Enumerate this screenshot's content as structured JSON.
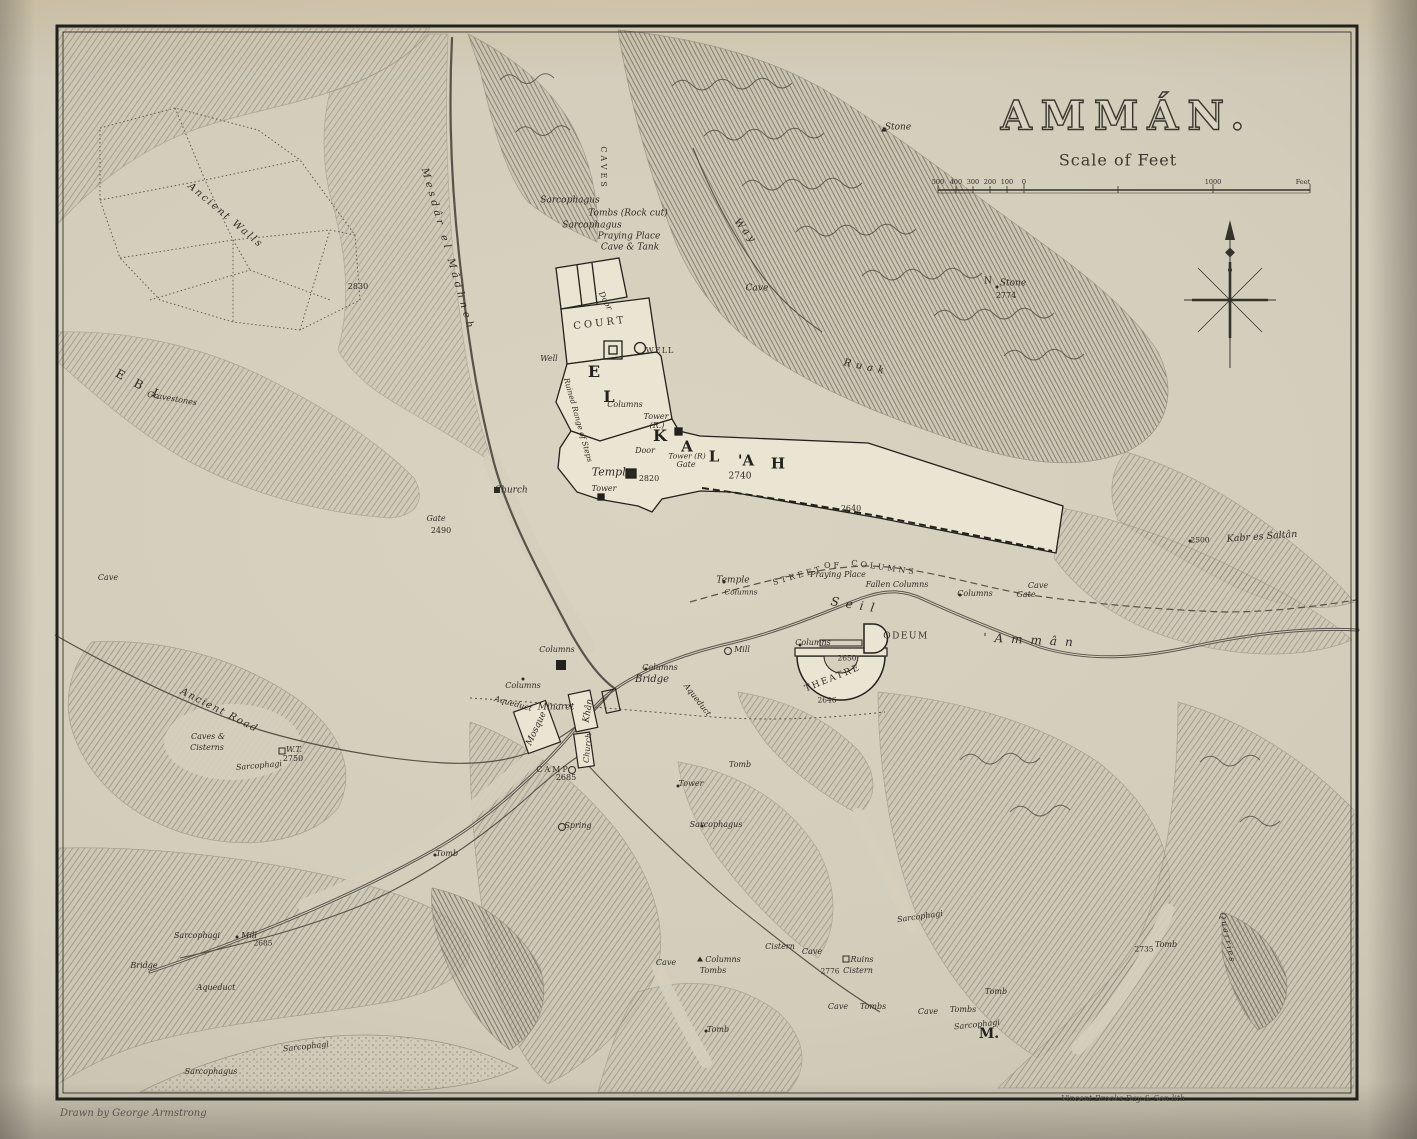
{
  "title": "AMMÁN.",
  "scale": {
    "caption": "Scale of Feet"
  },
  "credits": {
    "left": "Drawn by George Armstrong",
    "right": "Vincent Brooks Day & Son lith"
  },
  "colors": {
    "paper": "#d6d0bd",
    "ink": "#2e2b24",
    "terrain": "#7d786a"
  },
  "compass": {
    "icon": "compass-rose-north-arrow"
  },
  "labels": [
    {
      "t": "500",
      "x": 938,
      "y": 182,
      "s": 6.5,
      "c": "rom"
    },
    {
      "t": "400",
      "x": 956,
      "y": 182,
      "s": 6.5,
      "c": "rom"
    },
    {
      "t": "300",
      "x": 973,
      "y": 182,
      "s": 6.5,
      "c": "rom"
    },
    {
      "t": "200",
      "x": 990,
      "y": 182,
      "s": 6.5,
      "c": "rom"
    },
    {
      "t": "100",
      "x": 1007,
      "y": 182,
      "s": 6.5,
      "c": "rom"
    },
    {
      "t": "0",
      "x": 1024,
      "y": 182,
      "s": 6.5,
      "c": "rom"
    },
    {
      "t": "1000",
      "x": 1213,
      "y": 182,
      "s": 6.5,
      "c": "rom"
    },
    {
      "t": "Feet",
      "x": 1303,
      "y": 182,
      "s": 6.5,
      "c": "rom"
    },
    {
      "t": "Stone",
      "x": 898,
      "y": 128,
      "s": 9
    },
    {
      "t": "Stone",
      "x": 1013,
      "y": 284,
      "s": 9
    },
    {
      "t": "2774",
      "x": 1006,
      "y": 296,
      "s": 8,
      "c": "rom"
    },
    {
      "t": "N",
      "x": 988,
      "y": 282,
      "s": 9,
      "c": "rom"
    },
    {
      "t": "Way",
      "x": 745,
      "y": 232,
      "r": 50,
      "s": 10,
      "ls": 3
    },
    {
      "t": "CAVES",
      "x": 603,
      "y": 168,
      "r": 90,
      "s": 8,
      "ls": 3,
      "c": "caps"
    },
    {
      "t": "Sarcophagus",
      "x": 570,
      "y": 201,
      "s": 9
    },
    {
      "t": "Tombs (Rock cut)",
      "x": 628,
      "y": 214,
      "s": 9
    },
    {
      "t": "Sarcophagus",
      "x": 592,
      "y": 226,
      "s": 9
    },
    {
      "t": "Praying Place",
      "x": 629,
      "y": 237,
      "s": 9
    },
    {
      "t": "Cave & Tank",
      "x": 630,
      "y": 248,
      "s": 9
    },
    {
      "t": "Cave",
      "x": 757,
      "y": 289,
      "s": 9
    },
    {
      "t": "Ancient Walls",
      "x": 225,
      "y": 216,
      "r": 40,
      "s": 10,
      "ls": 2
    },
    {
      "t": "2830",
      "x": 358,
      "y": 287,
      "s": 8,
      "c": "rom"
    },
    {
      "t": "Mesdâr el Mâdhneh",
      "x": 447,
      "y": 250,
      "r": 74,
      "s": 10,
      "ls": 4
    },
    {
      "t": "Ruak",
      "x": 866,
      "y": 368,
      "r": 12,
      "s": 10,
      "ls": 5
    },
    {
      "t": "E B L",
      "x": 140,
      "y": 385,
      "r": 28,
      "s": 12,
      "ls": 4,
      "c": "rom"
    },
    {
      "t": "Gravestones",
      "x": 172,
      "y": 399,
      "r": 10,
      "s": 8
    },
    {
      "t": "COURT",
      "x": 600,
      "y": 324,
      "r": -7,
      "s": 10,
      "ls": 3,
      "c": "caps"
    },
    {
      "t": "Door",
      "x": 605,
      "y": 301,
      "r": 62,
      "s": 8
    },
    {
      "t": "WELL",
      "x": 660,
      "y": 351,
      "s": 8,
      "ls": 1,
      "c": "caps"
    },
    {
      "t": "Well",
      "x": 549,
      "y": 359,
      "s": 8
    },
    {
      "t": "E",
      "x": 594,
      "y": 372,
      "s": 16,
      "c": "big"
    },
    {
      "t": "L",
      "x": 609,
      "y": 397,
      "s": 16,
      "c": "big"
    },
    {
      "t": "K",
      "x": 660,
      "y": 436,
      "s": 16,
      "c": "big"
    },
    {
      "t": "A",
      "x": 687,
      "y": 447,
      "s": 15,
      "c": "big"
    },
    {
      "t": "L",
      "x": 714,
      "y": 457,
      "s": 15,
      "c": "big"
    },
    {
      "t": "'A",
      "x": 746,
      "y": 461,
      "s": 15,
      "c": "big"
    },
    {
      "t": "H",
      "x": 778,
      "y": 464,
      "s": 15,
      "c": "big"
    },
    {
      "t": "Ruined Range of Steps",
      "x": 578,
      "y": 420,
      "r": 74,
      "s": 7.5
    },
    {
      "t": "Columns",
      "x": 625,
      "y": 405,
      "s": 8
    },
    {
      "t": "Tower",
      "x": 656,
      "y": 417,
      "s": 8
    },
    {
      "t": "(R.)",
      "x": 657,
      "y": 426,
      "s": 8
    },
    {
      "t": "Door",
      "x": 645,
      "y": 451,
      "s": 8
    },
    {
      "t": "Tower (R)",
      "x": 687,
      "y": 456,
      "s": 7.5
    },
    {
      "t": "Gate",
      "x": 686,
      "y": 465,
      "s": 8
    },
    {
      "t": "Temple",
      "x": 612,
      "y": 472,
      "s": 11
    },
    {
      "t": "2820",
      "x": 649,
      "y": 479,
      "s": 8,
      "c": "rom"
    },
    {
      "t": "Tower",
      "x": 604,
      "y": 489,
      "s": 8
    },
    {
      "t": "2740",
      "x": 740,
      "y": 477,
      "s": 9,
      "c": "rom"
    },
    {
      "t": "2640",
      "x": 851,
      "y": 509,
      "s": 8,
      "c": "rom"
    },
    {
      "t": "Church",
      "x": 511,
      "y": 491,
      "s": 9
    },
    {
      "t": "Gate",
      "x": 436,
      "y": 519,
      "s": 8
    },
    {
      "t": "2490",
      "x": 441,
      "y": 531,
      "s": 8,
      "c": "rom"
    },
    {
      "t": "Kabr es Saltân",
      "x": 1262,
      "y": 537,
      "r": -4,
      "s": 9.5
    },
    {
      "t": "2500",
      "x": 1200,
      "y": 540,
      "s": 7.5,
      "c": "rom"
    },
    {
      "t": "Cave",
      "x": 108,
      "y": 578,
      "s": 8
    },
    {
      "t": "Temple",
      "x": 733,
      "y": 581,
      "s": 9
    },
    {
      "t": "Columns",
      "x": 741,
      "y": 592,
      "s": 7.5
    },
    {
      "t": "STREET",
      "x": 798,
      "y": 576,
      "r": -16,
      "s": 8,
      "ls": 3,
      "c": "caps"
    },
    {
      "t": "OF",
      "x": 833,
      "y": 566,
      "s": 8,
      "ls": 3,
      "c": "caps"
    },
    {
      "t": "COLUMNS",
      "x": 884,
      "y": 568,
      "r": 8,
      "s": 8,
      "ls": 3,
      "c": "caps"
    },
    {
      "t": "Praying Place",
      "x": 838,
      "y": 575,
      "s": 8
    },
    {
      "t": "Fallen Columns",
      "x": 897,
      "y": 585,
      "s": 8
    },
    {
      "t": "Columns",
      "x": 975,
      "y": 594,
      "s": 8
    },
    {
      "t": "Cave",
      "x": 1038,
      "y": 586,
      "s": 8
    },
    {
      "t": "Gate",
      "x": 1026,
      "y": 595,
      "s": 8
    },
    {
      "t": "Seil",
      "x": 856,
      "y": 605,
      "r": 9,
      "s": 12,
      "ls": 7
    },
    {
      "t": "'Ammân",
      "x": 1032,
      "y": 640,
      "r": 3,
      "s": 12,
      "ls": 8
    },
    {
      "t": "ODEUM",
      "x": 906,
      "y": 637,
      "s": 9,
      "ls": 1.5,
      "c": "caps"
    },
    {
      "t": "Columns",
      "x": 813,
      "y": 643,
      "s": 8
    },
    {
      "t": "2650",
      "x": 847,
      "y": 658,
      "s": 7.5,
      "c": "rom"
    },
    {
      "t": "THEATRE",
      "x": 833,
      "y": 679,
      "r": -22,
      "s": 9,
      "ls": 2,
      "c": "caps"
    },
    {
      "t": "2646",
      "x": 827,
      "y": 700,
      "s": 7.5,
      "c": "rom"
    },
    {
      "t": "Mill",
      "x": 742,
      "y": 650,
      "s": 8
    },
    {
      "t": "Columns",
      "x": 660,
      "y": 668,
      "s": 8
    },
    {
      "t": "Bridge",
      "x": 652,
      "y": 680,
      "s": 10
    },
    {
      "t": "Aqueduct",
      "x": 697,
      "y": 700,
      "r": 52,
      "s": 8
    },
    {
      "t": "Aqueduct",
      "x": 513,
      "y": 704,
      "r": 15,
      "s": 8
    },
    {
      "t": "Columns",
      "x": 557,
      "y": 650,
      "s": 8
    },
    {
      "t": "Columns",
      "x": 523,
      "y": 686,
      "s": 8
    },
    {
      "t": "Minaret",
      "x": 556,
      "y": 708,
      "s": 9
    },
    {
      "t": "Mosque",
      "x": 537,
      "y": 729,
      "r": -65,
      "s": 9
    },
    {
      "t": "Khân",
      "x": 589,
      "y": 711,
      "r": -80,
      "s": 9
    },
    {
      "t": "Church",
      "x": 588,
      "y": 748,
      "r": -85,
      "s": 8
    },
    {
      "t": "CAMP",
      "x": 553,
      "y": 770,
      "s": 8,
      "ls": 2,
      "c": "caps"
    },
    {
      "t": "2685",
      "x": 566,
      "y": 778,
      "s": 8,
      "c": "rom"
    },
    {
      "t": "Tomb",
      "x": 740,
      "y": 765,
      "s": 8
    },
    {
      "t": "Tower",
      "x": 691,
      "y": 784,
      "s": 8
    },
    {
      "t": "Sarcophagus",
      "x": 716,
      "y": 825,
      "s": 8
    },
    {
      "t": "Spring",
      "x": 578,
      "y": 826,
      "s": 8
    },
    {
      "t": "Tomb",
      "x": 447,
      "y": 854,
      "s": 8
    },
    {
      "t": "Ancient Road",
      "x": 219,
      "y": 711,
      "r": 27,
      "s": 10,
      "ls": 1.5
    },
    {
      "t": "Caves &",
      "x": 208,
      "y": 737,
      "s": 8
    },
    {
      "t": "Cisterns",
      "x": 207,
      "y": 748,
      "s": 8
    },
    {
      "t": "W.T.",
      "x": 294,
      "y": 750,
      "s": 8
    },
    {
      "t": "2750",
      "x": 293,
      "y": 759,
      "s": 8,
      "c": "rom"
    },
    {
      "t": "Sarcophagi",
      "x": 259,
      "y": 766,
      "r": -5,
      "s": 8
    },
    {
      "t": "Sarcophagi",
      "x": 197,
      "y": 936,
      "s": 8
    },
    {
      "t": "Mill",
      "x": 249,
      "y": 936,
      "s": 8
    },
    {
      "t": "2685",
      "x": 263,
      "y": 943,
      "s": 7.5,
      "c": "rom"
    },
    {
      "t": "Bridge",
      "x": 144,
      "y": 966,
      "s": 8
    },
    {
      "t": "Aqueduct",
      "x": 216,
      "y": 988,
      "s": 8
    },
    {
      "t": "Sarcophagi",
      "x": 306,
      "y": 1047,
      "r": -6,
      "s": 8
    },
    {
      "t": "Sarcophagus",
      "x": 211,
      "y": 1072,
      "s": 8
    },
    {
      "t": "Sarcophagi",
      "x": 920,
      "y": 917,
      "r": -8,
      "s": 8
    },
    {
      "t": "Cave",
      "x": 666,
      "y": 963,
      "s": 8
    },
    {
      "t": "Columns",
      "x": 723,
      "y": 960,
      "s": 8
    },
    {
      "t": "Tombs",
      "x": 713,
      "y": 971,
      "s": 8
    },
    {
      "t": "Cistern",
      "x": 780,
      "y": 947,
      "s": 8
    },
    {
      "t": "Cave",
      "x": 812,
      "y": 952,
      "s": 8
    },
    {
      "t": "Ruins",
      "x": 862,
      "y": 960,
      "s": 8
    },
    {
      "t": "2776",
      "x": 830,
      "y": 971,
      "s": 7.5,
      "c": "rom"
    },
    {
      "t": "Cistern",
      "x": 858,
      "y": 971,
      "s": 8
    },
    {
      "t": "Cave",
      "x": 838,
      "y": 1007,
      "s": 8
    },
    {
      "t": "Tombs",
      "x": 873,
      "y": 1007,
      "s": 8
    },
    {
      "t": "Cave",
      "x": 928,
      "y": 1012,
      "s": 8
    },
    {
      "t": "Tombs",
      "x": 963,
      "y": 1010,
      "s": 8
    },
    {
      "t": "Sarcophagi",
      "x": 977,
      "y": 1025,
      "r": -6,
      "s": 8
    },
    {
      "t": "M.",
      "x": 989,
      "y": 1034,
      "s": 14,
      "c": "big"
    },
    {
      "t": "Tomb",
      "x": 996,
      "y": 992,
      "s": 8
    },
    {
      "t": "Tomb",
      "x": 718,
      "y": 1030,
      "s": 8
    },
    {
      "t": "Quarries",
      "x": 1227,
      "y": 938,
      "r": 78,
      "s": 8,
      "ls": 2
    },
    {
      "t": "2735",
      "x": 1144,
      "y": 949,
      "s": 7.5,
      "c": "rom"
    },
    {
      "t": "Tomb",
      "x": 1166,
      "y": 945,
      "s": 8
    }
  ],
  "markers": [
    {
      "k": "tri",
      "x": 884,
      "y": 129
    },
    {
      "k": "dot",
      "x": 997,
      "y": 287
    },
    {
      "k": "sq",
      "x": 282,
      "y": 751
    },
    {
      "k": "sqf",
      "x": 632,
      "y": 474
    },
    {
      "k": "circ",
      "x": 728,
      "y": 651
    },
    {
      "k": "circ",
      "x": 562,
      "y": 827
    },
    {
      "k": "circ",
      "x": 572,
      "y": 770
    },
    {
      "k": "sq",
      "x": 846,
      "y": 959
    },
    {
      "k": "dot",
      "x": 800,
      "y": 645
    },
    {
      "k": "dot",
      "x": 523,
      "y": 679
    },
    {
      "k": "sqf",
      "x": 497,
      "y": 490
    },
    {
      "k": "dot",
      "x": 1190,
      "y": 541
    },
    {
      "k": "dot",
      "x": 646,
      "y": 669
    },
    {
      "k": "tri",
      "x": 700,
      "y": 959
    },
    {
      "k": "dot",
      "x": 237,
      "y": 937
    },
    {
      "k": "dot",
      "x": 706,
      "y": 1031
    },
    {
      "k": "dot",
      "x": 678,
      "y": 786
    },
    {
      "k": "dot",
      "x": 702,
      "y": 826
    },
    {
      "k": "dot",
      "x": 435,
      "y": 855
    },
    {
      "k": "dot",
      "x": 724,
      "y": 582
    },
    {
      "k": "dot",
      "x": 960,
      "y": 595
    }
  ]
}
